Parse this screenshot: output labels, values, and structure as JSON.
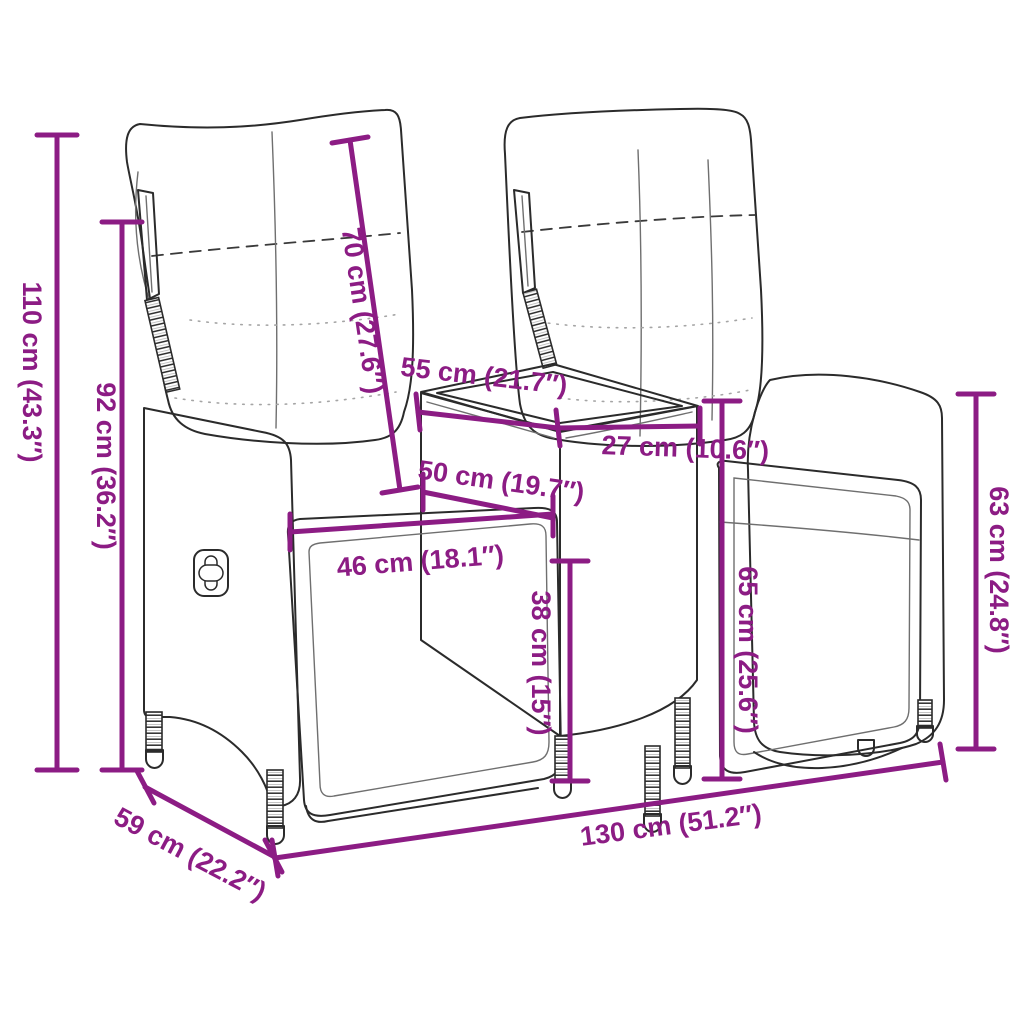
{
  "diagram": {
    "background_color": "#ffffff",
    "dimension_color": "#8C1C84",
    "line_art_color": "#2b2b2b",
    "dimensions": {
      "overall_height": "110 cm (43.3″)",
      "backrest_height": "92 cm (36.2″)",
      "backrest_length": "70 cm (27.6″)",
      "table_depth": "55 cm (21.7″)",
      "table_width": "27 cm (10.6″)",
      "seat_depth": "50 cm (19.7″)",
      "seat_width": "46 cm (18.1″)",
      "seat_height": "38 cm (15″)",
      "table_height": "65 cm (25.6″)",
      "side_height": "63 cm (24.8″)",
      "overall_depth": "59 cm (22.2″)",
      "overall_width": "130 cm (51.2″)"
    }
  }
}
